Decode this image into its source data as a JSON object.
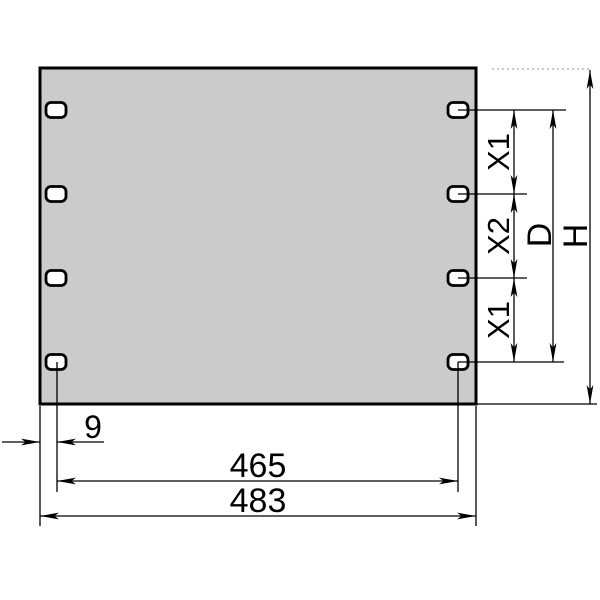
{
  "colors": {
    "panel_fill": "#cbcbcb",
    "line": "#000000",
    "hidden_line": "#b5b5b5",
    "background": "#ffffff"
  },
  "dimensions": {
    "edge_to_hole": "9",
    "hole_span": "465",
    "overall_width": "483",
    "x1_upper": "X1",
    "x2": "X2",
    "x1_lower": "X1",
    "hole_field_height": "D",
    "overall_height": "H"
  }
}
